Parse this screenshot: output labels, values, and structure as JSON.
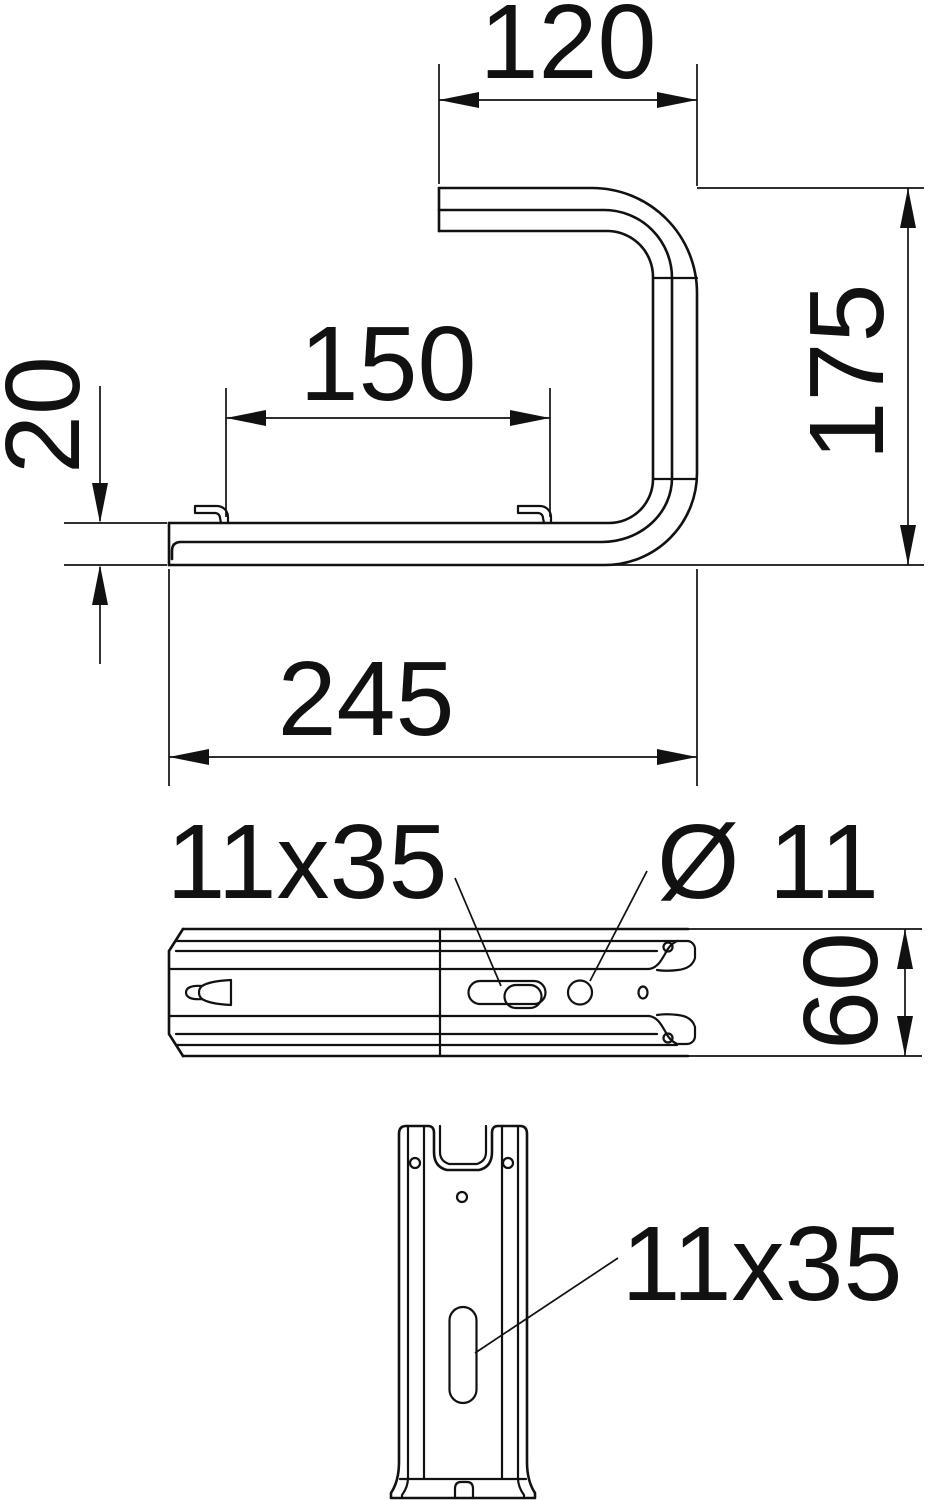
{
  "drawing": {
    "side_view": {
      "dim_top_flange_width": "120",
      "dim_height": "175",
      "dim_inner_width": "150",
      "dim_end_thickness": "20",
      "dim_length": "245"
    },
    "plan_view": {
      "slot_label": "11x35",
      "hole_label": "Ø 11",
      "dim_rail_width": "60"
    },
    "front_view": {
      "slot_label": "11x35"
    },
    "colors": {
      "line": "#111111",
      "background": "#ffffff"
    }
  }
}
